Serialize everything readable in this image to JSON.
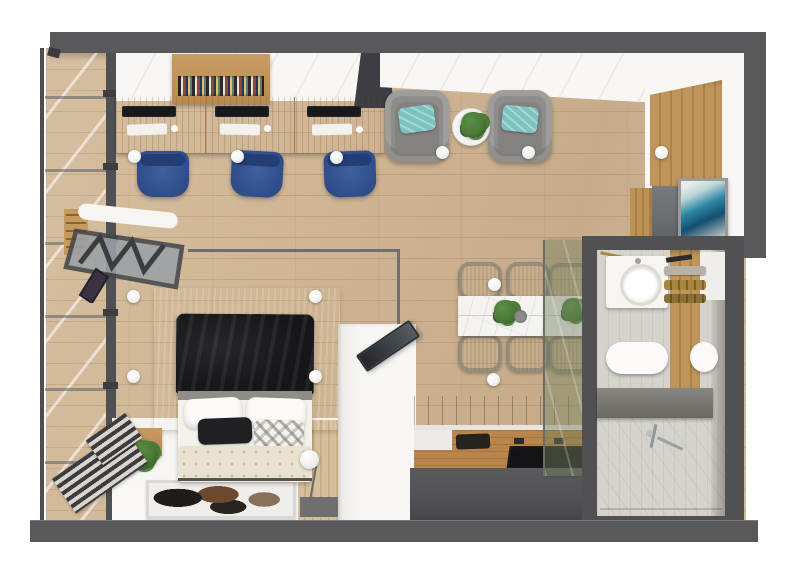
{
  "scene": {
    "label": "studio-apartment-top-view-render",
    "view": "top-down 3d architectural render",
    "has_visible_text": false
  },
  "rooms": [
    {
      "id": "office",
      "label": "Home office",
      "items": [
        "wooden desk with three workstations",
        "three blue swivel chairs",
        "wall bookshelf with books",
        "white storage cabinets"
      ]
    },
    {
      "id": "living",
      "label": "Lounge area",
      "items": [
        "two gray armchairs with teal cushions",
        "round white side table",
        "green plant"
      ]
    },
    {
      "id": "bedroom",
      "label": "Sleeping area",
      "items": [
        "double bed with black throw and white duvet",
        "tufted cream bench",
        "gray area rug",
        "cowhide accent rug",
        "floor ball lamp",
        "wooden nightstand with plant",
        "wall-mounted folding desk with truss legs",
        "leaning TV on white cabinet"
      ]
    },
    {
      "id": "dining",
      "label": "Dining area",
      "items": [
        "white stone dining table",
        "six gray upholstered chairs",
        "two table plants",
        "gray bowl",
        "smoked glass partition"
      ]
    },
    {
      "id": "kitchen",
      "label": "Kitchenette",
      "items": [
        "wood countertop",
        "undermount sink",
        "black cooktop",
        "dark cabinet front",
        "dark wood backsplash"
      ]
    },
    {
      "id": "bathroom",
      "label": "Bathroom",
      "items": [
        "vanity with round basin",
        "wall-hung toilet",
        "wood towel panel with brass towel bars",
        "gray counter",
        "walk-in shower with chrome mixer",
        "white door"
      ]
    },
    {
      "id": "entry",
      "label": "Entry",
      "items": [
        "wood slat feature wall",
        "blue abstract artwork",
        "gray art panel",
        "wood sideboard",
        "white ball pendant"
      ]
    },
    {
      "id": "window",
      "label": "Window wall",
      "items": [
        "floor-to-ceiling glazing with dark mullions",
        "slatted radiator panels",
        "window bench plant"
      ]
    }
  ],
  "lights": {
    "style": "white ball ceiling lights",
    "count": 12
  },
  "palette": {
    "wall": "#59595c",
    "floor": "#d0b695",
    "wood": "#c89a5f",
    "wood-dark": "#a87a42",
    "glass": "#e9edef",
    "mullion": "#4f5054",
    "white-soft": "#f8f7f4",
    "teal": "#7cc2bf",
    "chair-blue": "#33518f",
    "arm-gray": "#8e8d8a",
    "rug": "#a5a29b",
    "bed-black": "#17171a",
    "cream": "#e9e2d0",
    "dchair": "#a19f9b",
    "marble": "#f4f3f0",
    "glass-green": "rgba(112,128,96,0.45)",
    "counter-front": "#525256",
    "counter-wood": "#b9854c",
    "cooktop": "#141417",
    "backsplash": "#64492c",
    "tile": "#d6d2cc",
    "tile-light": "#e7e4de",
    "panel-wood": "#b9854c",
    "gold": "#a5873f",
    "green": "#4a7a36",
    "art-blue": "#2f86a6",
    "art-blue-deep": "#124f70"
  }
}
